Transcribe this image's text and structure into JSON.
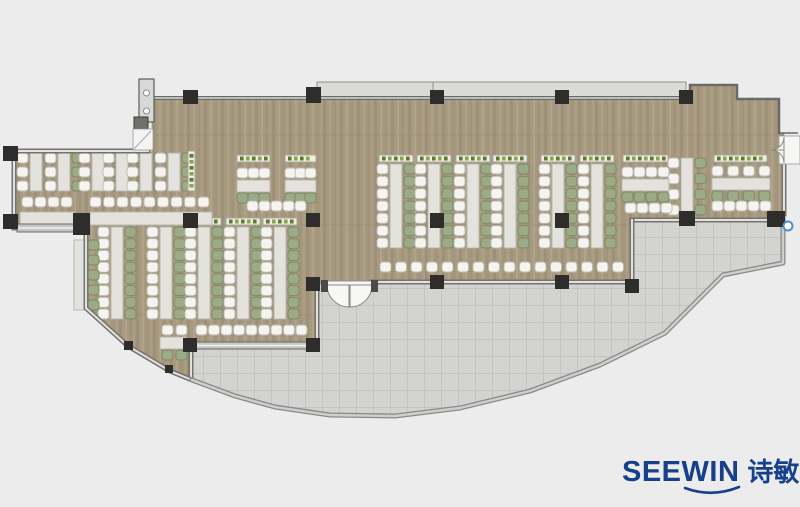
{
  "logo": {
    "wordmark": "SEEWIN",
    "chinese": "诗敏",
    "color": "#163f8c"
  },
  "plan": {
    "background": "#ececec",
    "floor_fill": "#a79a81",
    "terrace_fill": "#d3d3d1",
    "wall_color": "#6b6a68",
    "column_color": "#2e2d2b",
    "hotspot_color": "#4e8fd0"
  },
  "furniture": {
    "colors": {
      "desk": "#e4e2dc",
      "desk_border": "#b6b3ab",
      "chair_white": "#f5f4f0",
      "chair_white_border": "#bcbab3",
      "chair_green": "#9cab85",
      "chair_green_border": "#7a8963",
      "planter_bg": "#efede2",
      "planter_border": "#a6a49a",
      "planter_dot_dark": "#5c7a36",
      "planter_dot_light": "#8aa44f",
      "counter": "#dcdad3"
    },
    "v_strip_groups": [
      {
        "name": "wing-upper-rows",
        "desks_x": [
          30,
          58,
          92,
          116,
          140,
          168
        ],
        "y": 153,
        "h": 38,
        "chairs": 3,
        "planter": false,
        "right_only": false
      },
      {
        "name": "southwest-rows",
        "desks_x": [
          111,
          160,
          198,
          237,
          274
        ],
        "y": 227,
        "h": 92,
        "chairs": 8,
        "planter": true,
        "right_only": false
      },
      {
        "name": "southwest-edge-row",
        "desks_x": [
          74
        ],
        "y": 240,
        "h": 70,
        "chairs": 5,
        "planter": false,
        "right_only": true
      },
      {
        "name": "center-rows",
        "desks_x": [
          390,
          428,
          467,
          504,
          552,
          591
        ],
        "y": 164,
        "h": 84,
        "chairs": 7,
        "planter": true,
        "right_only": false
      },
      {
        "name": "east-row",
        "desks_x": [
          681
        ],
        "y": 158,
        "h": 57,
        "chairs": 4,
        "planter": false,
        "right_only": false
      }
    ],
    "h_table_groups": [
      {
        "name": "mid-tables",
        "y": 180,
        "chairs": 3,
        "tables": [
          {
            "x": 237,
            "w": 33
          },
          {
            "x": 285,
            "w": 31
          }
        ]
      },
      {
        "name": "east-table-1",
        "y": 179,
        "chairs": 4,
        "tables": [
          {
            "x": 622,
            "w": 47
          }
        ]
      },
      {
        "name": "east-table-2",
        "y": 178,
        "chairs": 4,
        "tables": [
          {
            "x": 712,
            "w": 58
          }
        ]
      }
    ],
    "planters_h": [
      {
        "x": 237,
        "y": 155,
        "w": 33
      },
      {
        "x": 285,
        "y": 155,
        "w": 31
      },
      {
        "x": 623,
        "y": 155,
        "w": 45
      },
      {
        "x": 714,
        "y": 155,
        "w": 53
      },
      {
        "x": 100,
        "y": 215,
        "w": 30
      },
      {
        "x": 162,
        "y": 215,
        "w": 50
      }
    ],
    "v_planters": [
      {
        "x": 188,
        "y": 151,
        "h": 40
      }
    ],
    "counters": [
      {
        "x": 20,
        "y": 212,
        "w": 55
      },
      {
        "x": 90,
        "y": 212,
        "w": 122
      }
    ],
    "chair_rows": [
      {
        "x": 22,
        "y": 197,
        "n": 4,
        "pitch": 13
      },
      {
        "x": 90,
        "y": 197,
        "n": 9,
        "pitch": 13.5
      },
      {
        "x": 247,
        "y": 201,
        "n": 5,
        "pitch": 12
      },
      {
        "x": 380,
        "y": 262,
        "n": 16,
        "pitch": 15.5
      },
      {
        "x": 196,
        "y": 325,
        "n": 9,
        "pitch": 12.5
      },
      {
        "x": 625,
        "y": 203,
        "n": 4,
        "pitch": 12
      },
      {
        "x": 712,
        "y": 201,
        "n": 5,
        "pitch": 12
      }
    ],
    "corner_table": {
      "x": 160,
      "y": 337,
      "w": 26,
      "h": 12
    }
  }
}
